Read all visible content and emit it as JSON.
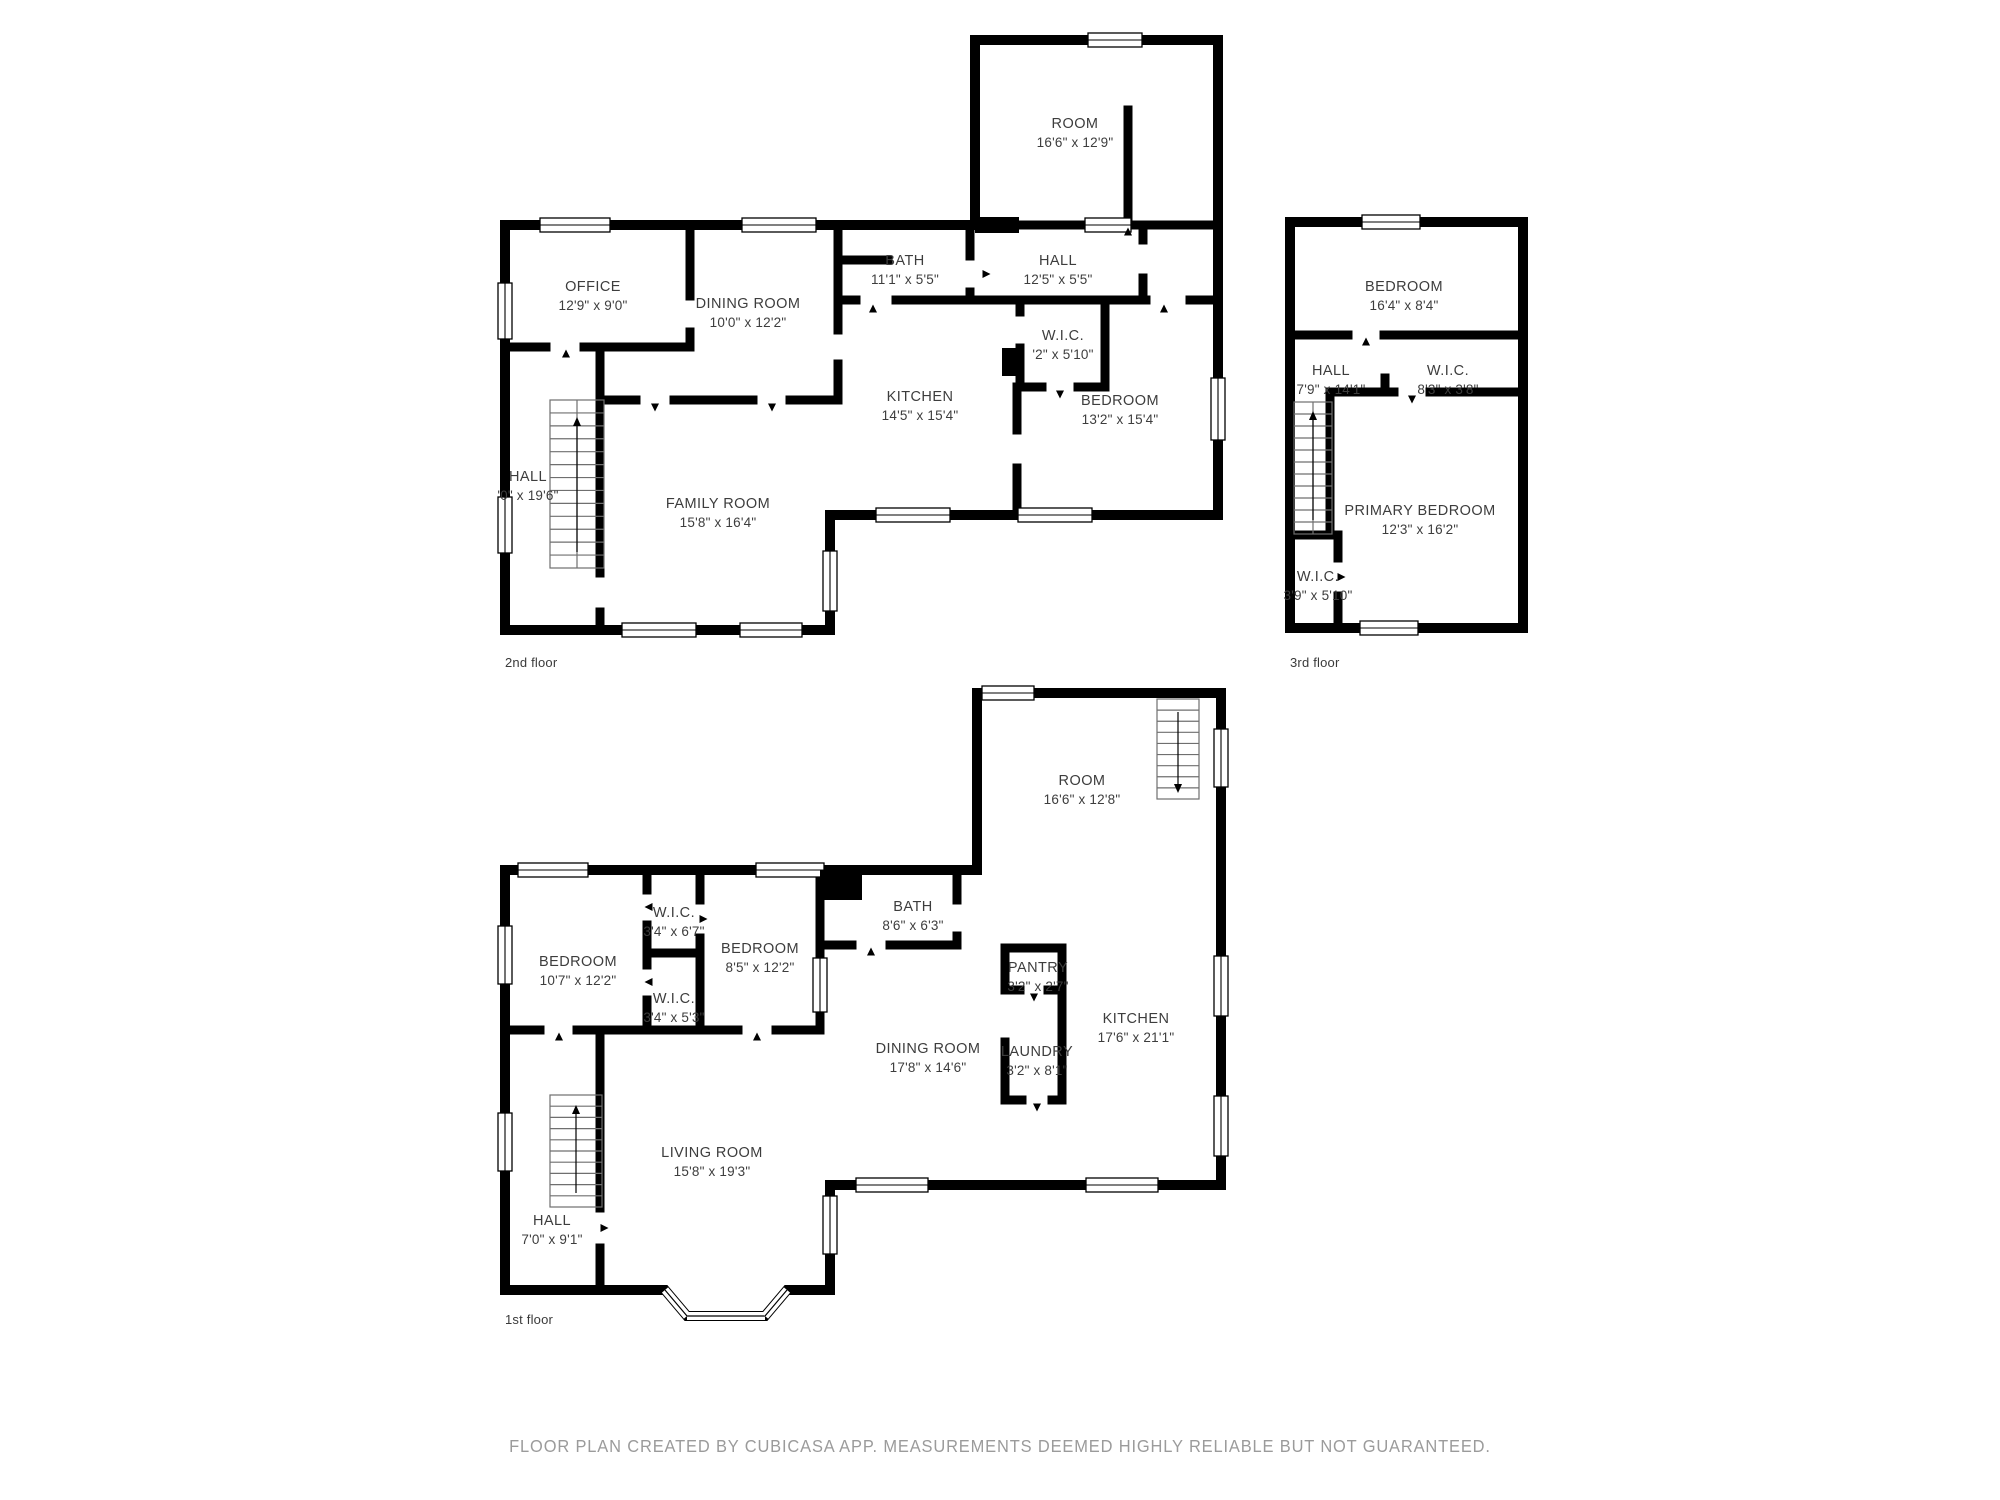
{
  "footer": {
    "text": "FLOOR PLAN CREATED BY CUBICASA APP. MEASUREMENTS DEEMED HIGHLY RELIABLE BUT NOT GUARANTEED."
  },
  "colors": {
    "wall": "#000000",
    "label": "#3d3d3d",
    "stairs": "#6f6f6f",
    "footer": "#9b9b9b"
  },
  "floors": [
    {
      "caption": "2nd floor",
      "rooms": [
        {
          "name": "ROOM",
          "dims": "16'6\" x 12'9\""
        },
        {
          "name": "BATH",
          "dims": "11'1\" x 5'5\""
        },
        {
          "name": "HALL",
          "dims": "12'5\" x 5'5\""
        },
        {
          "name": "OFFICE",
          "dims": "12'9\" x 9'0\""
        },
        {
          "name": "DINING ROOM",
          "dims": "10'0\" x 12'2\""
        },
        {
          "name": "W.I.C.",
          "dims": "'2\" x 5'10\""
        },
        {
          "name": "KITCHEN",
          "dims": "14'5\" x 15'4\""
        },
        {
          "name": "BEDROOM",
          "dims": "13'2\" x 15'4\""
        },
        {
          "name": "HALL",
          "dims": "'0\" x 19'6\""
        },
        {
          "name": "FAMILY ROOM",
          "dims": "15'8\" x 16'4\""
        }
      ]
    },
    {
      "caption": "3rd floor",
      "rooms": [
        {
          "name": "BEDROOM",
          "dims": "16'4\" x 8'4\""
        },
        {
          "name": "HALL",
          "dims": "7'9\" x 14'1\""
        },
        {
          "name": "W.I.C.",
          "dims": "8'3\" x 3'8\""
        },
        {
          "name": "PRIMARY BEDROOM",
          "dims": "12'3\" x 16'2\""
        },
        {
          "name": "W.I.C.",
          "dims": "3'9\" x 5'10\""
        }
      ]
    },
    {
      "caption": "1st floor",
      "rooms": [
        {
          "name": "ROOM",
          "dims": "16'6\" x 12'8\""
        },
        {
          "name": "BATH",
          "dims": "8'6\" x 6'3\""
        },
        {
          "name": "W.I.C.",
          "dims": "3'4\" x 6'7\""
        },
        {
          "name": "BEDROOM",
          "dims": "10'7\" x 12'2\""
        },
        {
          "name": "BEDROOM",
          "dims": "8'5\" x 12'2\""
        },
        {
          "name": "W.I.C.",
          "dims": "3'4\" x 5'3\""
        },
        {
          "name": "PANTRY",
          "dims": "3'2\" x 2'7\""
        },
        {
          "name": "KITCHEN",
          "dims": "17'6\" x 21'1\""
        },
        {
          "name": "DINING ROOM",
          "dims": "17'8\" x 14'6\""
        },
        {
          "name": "LAUNDRY",
          "dims": "3'2\" x 8'1\""
        },
        {
          "name": "LIVING ROOM",
          "dims": "15'8\" x 19'3\""
        },
        {
          "name": "HALL",
          "dims": "7'0\" x 9'1\""
        }
      ]
    }
  ]
}
